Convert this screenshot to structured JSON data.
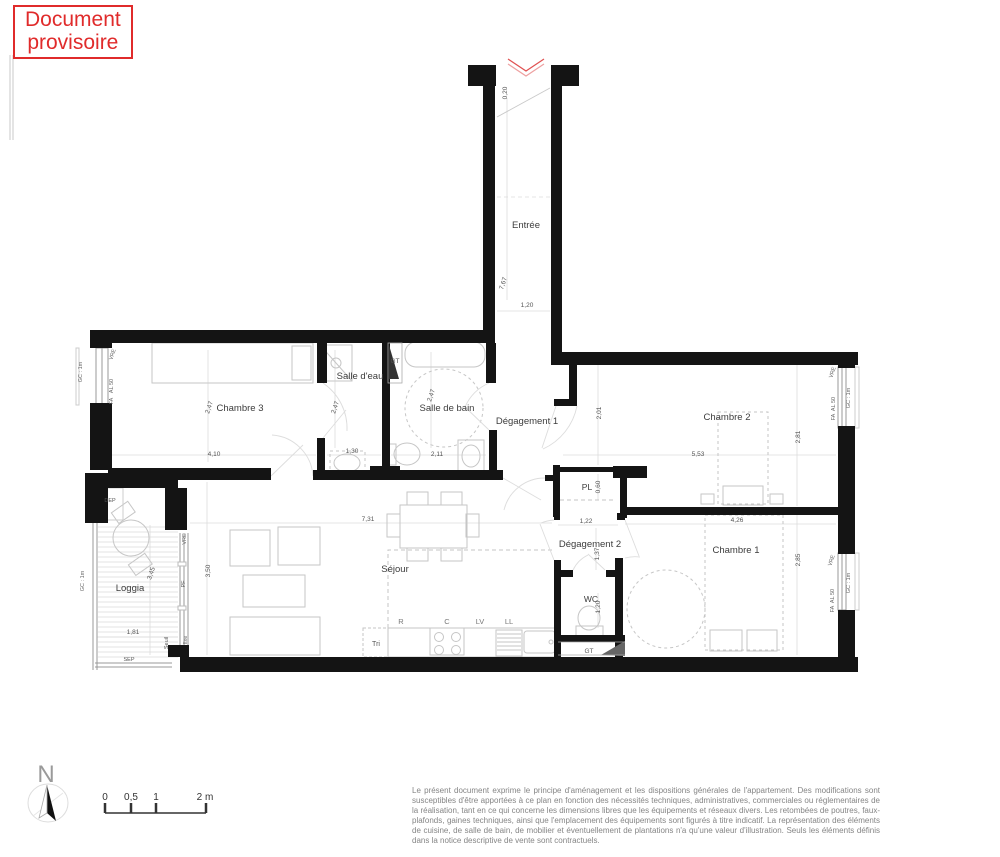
{
  "stamp": {
    "line1": "Document",
    "line2": "provisoire"
  },
  "disclaimer": {
    "text": "Le présent document exprime le principe d'aménagement et les dispositions générales de l'appartement. Des modifications sont susceptibles d'être apportées à ce plan en fonction des nécessités techniques, administratives, commerciales ou réglementaires de la réalisation, tant en ce qui concerne les dimensions libres que les équipements et réseaux divers. Les retombées de poutres, faux-plafonds, gaines techniques, ainsi que l'emplacement des équipements sont figurés à titre indicatif. La représentation des éléments de cuisine, de salle de bain, de mobilier et éventuellement de plantations n'a qu'une valeur d'illustration. Seuls les éléments définis dans la notice descriptive de vente sont contractuels."
  },
  "colors": {
    "wall": "#141414",
    "red": "#e02b2b",
    "dim": "#555555",
    "room": "#3c3c3c",
    "window_label": "#666666",
    "furniture": "#c6c6c6"
  },
  "plan": {
    "texts": [
      {
        "t": "Entrée",
        "x": 526,
        "y": 228,
        "s": 9.5,
        "c": "#3c3c3c",
        "name": "room-label-entree"
      },
      {
        "t": "Chambre 3",
        "x": 240,
        "y": 411,
        "s": 9.5,
        "c": "#3c3c3c",
        "name": "room-label-chambre-3"
      },
      {
        "t": "Salle d'eau",
        "x": 360,
        "y": 379,
        "s": 9.5,
        "c": "#3c3c3c",
        "name": "room-label-salle-deau"
      },
      {
        "t": "Salle de bain",
        "x": 447,
        "y": 411,
        "s": 9.5,
        "c": "#3c3c3c",
        "name": "room-label-salle-de-bain"
      },
      {
        "t": "Dégagement 1",
        "x": 527,
        "y": 424,
        "s": 9.5,
        "c": "#3c3c3c",
        "name": "room-label-degagement-1"
      },
      {
        "t": "Chambre 2",
        "x": 727,
        "y": 420,
        "s": 9.5,
        "c": "#3c3c3c",
        "name": "room-label-chambre-2"
      },
      {
        "t": "PL",
        "x": 587,
        "y": 490,
        "s": 8.5,
        "c": "#3c3c3c",
        "name": "room-label-pl"
      },
      {
        "t": "Séjour",
        "x": 395,
        "y": 572,
        "s": 9.5,
        "c": "#3c3c3c",
        "name": "room-label-sejour"
      },
      {
        "t": "Loggia",
        "x": 130,
        "y": 591,
        "s": 9.5,
        "c": "#3c3c3c",
        "name": "room-label-loggia"
      },
      {
        "t": "Dégagement 2",
        "x": 590,
        "y": 547,
        "s": 9.5,
        "c": "#3c3c3c",
        "name": "room-label-degagement-2"
      },
      {
        "t": "WC",
        "x": 591,
        "y": 602,
        "s": 8.5,
        "c": "#3c3c3c",
        "name": "room-label-wc"
      },
      {
        "t": "Chambre 1",
        "x": 736,
        "y": 553,
        "s": 9.5,
        "c": "#3c3c3c",
        "name": "room-label-chambre-1"
      },
      {
        "t": "0,20",
        "x": 507,
        "y": 93,
        "r": -90,
        "s": 6.5,
        "name": "dim-0-20"
      },
      {
        "t": "7,67",
        "x": 505,
        "y": 284,
        "r": -72,
        "s": 6.5,
        "name": "dim-7-67"
      },
      {
        "t": "1,20",
        "x": 527,
        "y": 307,
        "s": 6.5,
        "name": "dim-1-20-entree"
      },
      {
        "t": "2,47",
        "x": 211,
        "y": 408,
        "r": -72,
        "s": 6.5,
        "name": "dim-2-47-chambre3"
      },
      {
        "t": "4,10",
        "x": 214,
        "y": 456,
        "s": 6.5,
        "name": "dim-4-10"
      },
      {
        "t": "2,47",
        "x": 337,
        "y": 408,
        "r": -72,
        "s": 6.5,
        "name": "dim-2-47-salle-deau"
      },
      {
        "t": "1,30",
        "x": 352,
        "y": 453,
        "s": 6.5,
        "name": "dim-1-30"
      },
      {
        "t": "2,47",
        "x": 433,
        "y": 396,
        "r": -72,
        "s": 6.5,
        "name": "dim-2-47-salle-de-bain"
      },
      {
        "t": "2,11",
        "x": 437,
        "y": 456,
        "s": 6.5,
        "name": "dim-2-11"
      },
      {
        "t": "2,01",
        "x": 601,
        "y": 413,
        "r": -90,
        "s": 6.5,
        "name": "dim-2-01"
      },
      {
        "t": "5,53",
        "x": 698,
        "y": 456,
        "s": 6.5,
        "name": "dim-5-53"
      },
      {
        "t": "2,81",
        "x": 800,
        "y": 437,
        "r": -90,
        "s": 6.5,
        "name": "dim-2-81"
      },
      {
        "t": "0,60",
        "x": 600,
        "y": 487,
        "r": -90,
        "s": 6.5,
        "name": "dim-0-60"
      },
      {
        "t": "1,22",
        "x": 586,
        "y": 523,
        "s": 6.5,
        "name": "dim-1-22"
      },
      {
        "t": "1,37",
        "x": 599,
        "y": 554,
        "r": -90,
        "s": 6.5,
        "name": "dim-1-37"
      },
      {
        "t": "1,20",
        "x": 600,
        "y": 607,
        "r": -90,
        "s": 6.5,
        "name": "dim-1-20-wc"
      },
      {
        "t": "4,26",
        "x": 737,
        "y": 522,
        "s": 6.5,
        "name": "dim-4-26"
      },
      {
        "t": "2,85",
        "x": 800,
        "y": 560,
        "r": -90,
        "s": 6.5,
        "name": "dim-2-85"
      },
      {
        "t": "7,31",
        "x": 368,
        "y": 521,
        "s": 6.5,
        "name": "dim-7-31"
      },
      {
        "t": "3,50",
        "x": 210,
        "y": 571,
        "r": -90,
        "s": 6.5,
        "name": "dim-3-50"
      },
      {
        "t": "3,45",
        "x": 153,
        "y": 574,
        "r": -72,
        "s": 6.5,
        "name": "dim-3-45"
      },
      {
        "t": "1,81",
        "x": 133,
        "y": 634,
        "s": 6.5,
        "name": "dim-1-81"
      },
      {
        "t": "GT",
        "x": 395,
        "y": 363,
        "s": 6.5,
        "name": "label-gt-salle-deau"
      },
      {
        "t": "GT",
        "x": 589,
        "y": 653,
        "s": 6.5,
        "name": "label-gt-wc"
      },
      {
        "t": "DEP",
        "x": 110,
        "y": 502,
        "s": 5.5,
        "name": "label-dep"
      },
      {
        "t": "SEP",
        "x": 129,
        "y": 661,
        "s": 5.5,
        "name": "label-sep"
      },
      {
        "t": "Seuil",
        "x": 168,
        "y": 643,
        "r": -90,
        "s": 5.5,
        "name": "label-seuil"
      },
      {
        "t": "Tri",
        "x": 376,
        "y": 646,
        "s": 7,
        "name": "label-tri"
      },
      {
        "t": "R",
        "x": 401,
        "y": 624,
        "s": 7.5,
        "c": "#777777",
        "name": "label-kitchen-r"
      },
      {
        "t": "C",
        "x": 447,
        "y": 624,
        "s": 7.5,
        "c": "#777777",
        "name": "label-kitchen-c"
      },
      {
        "t": "LV",
        "x": 480,
        "y": 624,
        "s": 7.5,
        "c": "#777777",
        "name": "label-kitchen-lv"
      },
      {
        "t": "LL",
        "x": 509,
        "y": 624,
        "s": 7.5,
        "c": "#777777",
        "name": "label-kitchen-ll"
      },
      {
        "t": "VRE",
        "x": 114,
        "y": 355,
        "r": -72,
        "s": 5.5,
        "c": "#666666",
        "name": "window-label-vre-chambre3"
      },
      {
        "t": "AL 50",
        "x": 113,
        "y": 386,
        "r": -90,
        "s": 5.5,
        "c": "#666666",
        "name": "window-label-al50-chambre3"
      },
      {
        "t": "FA",
        "x": 113,
        "y": 401,
        "r": -90,
        "s": 5.5,
        "c": "#666666",
        "name": "window-label-fa-chambre3"
      },
      {
        "t": "GC : 1m",
        "x": 82,
        "y": 372,
        "r": -90,
        "s": 5.5,
        "c": "#666666",
        "name": "window-label-gc1m-chambre3"
      },
      {
        "t": "VRE",
        "x": 834,
        "y": 373,
        "r": -72,
        "s": 5.5,
        "c": "#666666",
        "name": "window-label-vre-chambre2"
      },
      {
        "t": "AL 50",
        "x": 835,
        "y": 404,
        "r": -90,
        "s": 5.5,
        "c": "#666666",
        "name": "window-label-al50-chambre2"
      },
      {
        "t": "FA",
        "x": 835,
        "y": 417,
        "r": -90,
        "s": 5.5,
        "c": "#666666",
        "name": "window-label-fa-chambre2"
      },
      {
        "t": "GC : 1m",
        "x": 850,
        "y": 398,
        "r": -90,
        "s": 5.5,
        "c": "#666666",
        "name": "window-label-gc1m-chambre2"
      },
      {
        "t": "VRE",
        "x": 833,
        "y": 561,
        "r": -72,
        "s": 5.5,
        "c": "#666666",
        "name": "window-label-vre-chambre1"
      },
      {
        "t": "AL 50",
        "x": 834,
        "y": 596,
        "r": -90,
        "s": 5.5,
        "c": "#666666",
        "name": "window-label-al50-chambre1"
      },
      {
        "t": "FA",
        "x": 834,
        "y": 609,
        "r": -90,
        "s": 5.5,
        "c": "#666666",
        "name": "window-label-fa-chambre1"
      },
      {
        "t": "GC : 1m",
        "x": 850,
        "y": 583,
        "r": -90,
        "s": 5.5,
        "c": "#666666",
        "name": "window-label-gc1m-chambre1"
      },
      {
        "t": "GC : 1m",
        "x": 84,
        "y": 581,
        "r": -90,
        "s": 5.5,
        "c": "#666666",
        "name": "window-label-gc1m-loggia"
      },
      {
        "t": "VRE",
        "x": 186,
        "y": 539,
        "r": -90,
        "s": 5.5,
        "c": "#666666",
        "name": "window-label-vre-sejour"
      },
      {
        "t": "PF",
        "x": 185,
        "y": 584,
        "r": -90,
        "s": 5.5,
        "c": "#666666",
        "name": "window-label-pf-sejour"
      },
      {
        "t": "fixe",
        "x": 187,
        "y": 640,
        "r": -90,
        "s": 5.5,
        "c": "#666666",
        "name": "window-label-fixe-sejour"
      },
      {
        "t": "N",
        "x": 46,
        "y": 782,
        "s": 24,
        "c": "#9a9a9a",
        "name": "north-letter"
      },
      {
        "t": "0",
        "x": 105,
        "y": 800,
        "s": 10,
        "c": "#333333",
        "name": "scale-label-0"
      },
      {
        "t": "0,5",
        "x": 131,
        "y": 800,
        "s": 10,
        "c": "#333333",
        "name": "scale-label-05"
      },
      {
        "t": "1",
        "x": 156,
        "y": 800,
        "s": 10,
        "c": "#333333",
        "name": "scale-label-1"
      },
      {
        "t": "2 m",
        "x": 205,
        "y": 800,
        "s": 10,
        "c": "#333333",
        "name": "scale-label-2m"
      }
    ]
  }
}
